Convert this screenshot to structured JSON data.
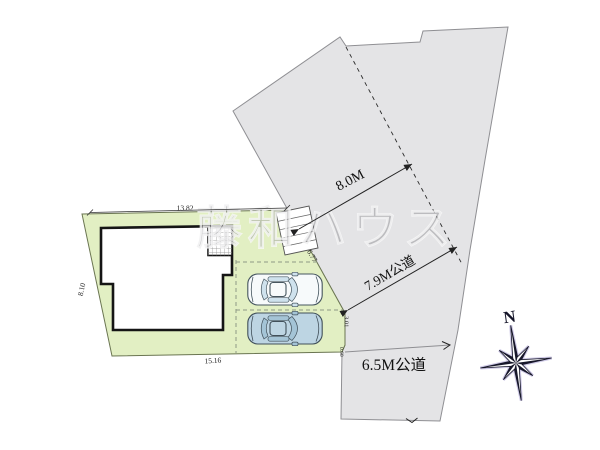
{
  "watermark_text": "藤和ハウス",
  "road_labels": {
    "top_road_width": "8.0M",
    "right_road": "7.9M公道",
    "bottom_road": "6.5M公道"
  },
  "lot_dimensions": {
    "top": "13.82",
    "left": "8.10",
    "bottom": "15.16",
    "diagonal_right": "6.77",
    "right_vertical": "3.01",
    "corner_cut": "0.60"
  },
  "compass": {
    "north_label": "N"
  },
  "colors": {
    "lot_fill": "#e2efc3",
    "road_fill": "#e4e4e6",
    "house_fill": "#ffffff",
    "outline": "#151515",
    "watermark": "#86868a"
  }
}
